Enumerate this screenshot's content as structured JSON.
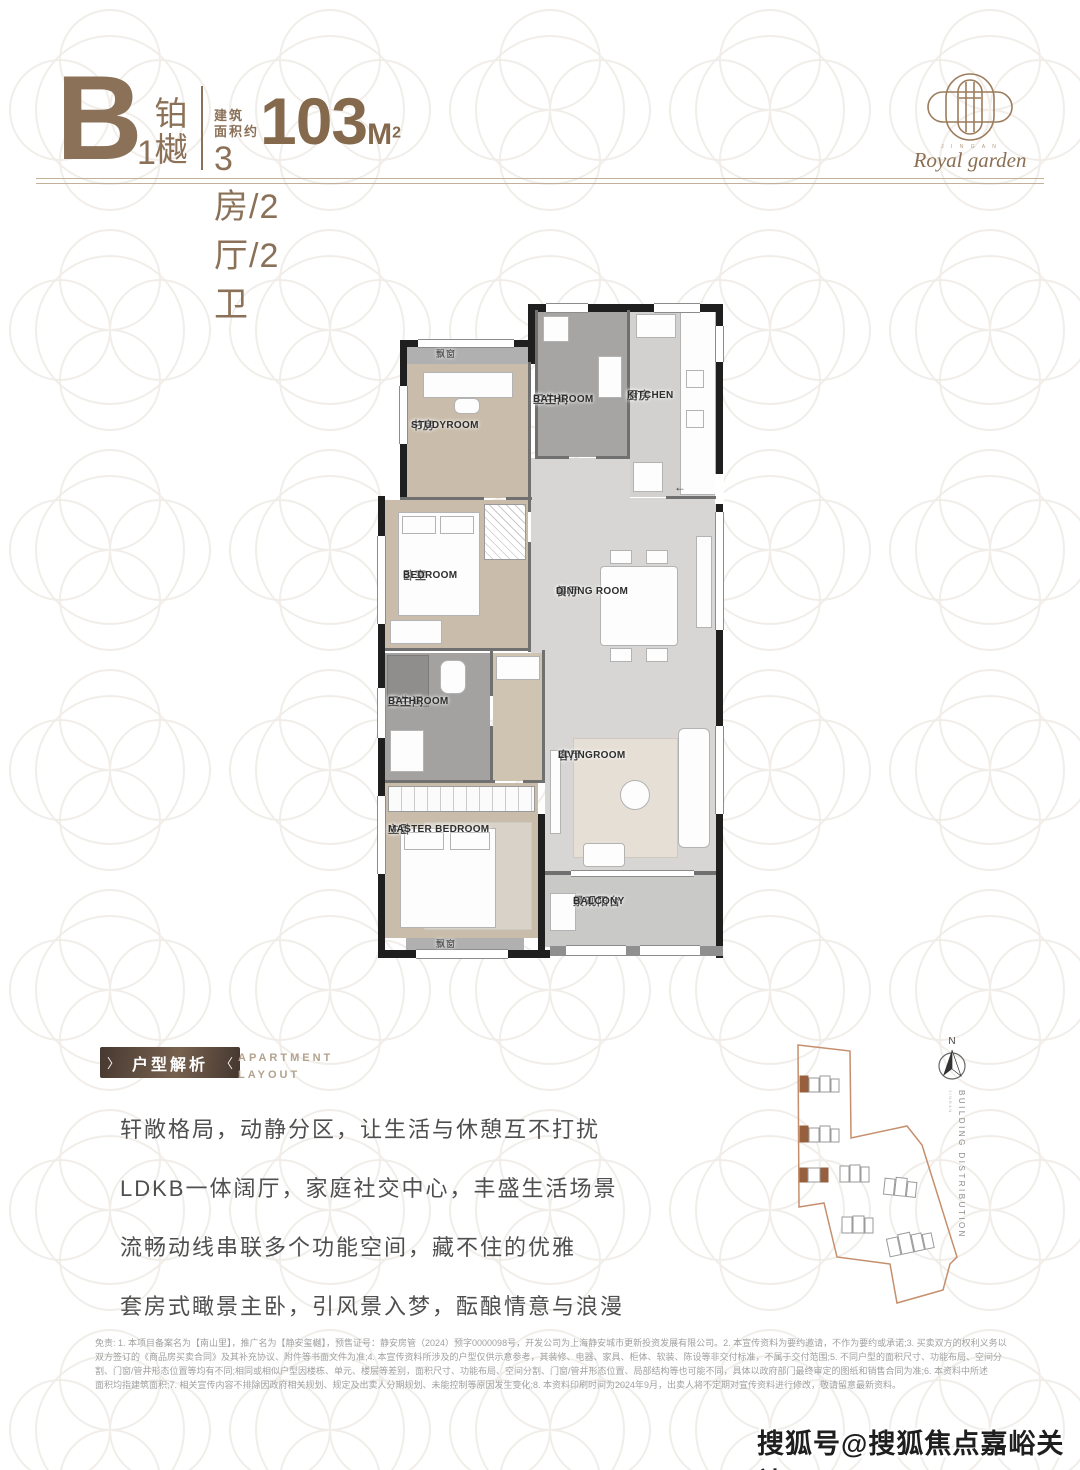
{
  "colors": {
    "accent": "#8a7158",
    "badge_dark": "#473931",
    "map_outline": "#c58f6d",
    "map_highlight": "#96603f",
    "wall_black": "#1f1f1f",
    "floor_wood": "#c9bcaa",
    "floor_marble": "#d7d6d4"
  },
  "header": {
    "type_letter": "B",
    "type_number": "1",
    "type_name_chars": [
      "铂",
      "樾"
    ],
    "area_label_line1": "建筑",
    "area_label_line2": "面积约",
    "area_value": "103",
    "area_unit": "M",
    "area_unit_sup": "2",
    "layout_spec": "3房/2厅/2卫"
  },
  "logo": {
    "brand_small": "J I N G A N",
    "brand_script": "Royal garden"
  },
  "plan": {
    "bay_window_label": "飘窗",
    "entry_arrow": "←",
    "rooms": [
      {
        "cn": "书房",
        "en": "STUDYROOM"
      },
      {
        "cn": "卫生间",
        "en": "BATHROOM"
      },
      {
        "cn": "厨房",
        "en": "KITCHEN"
      },
      {
        "cn": "卧室",
        "en": "BEDROOM"
      },
      {
        "cn": "餐厅",
        "en": "DINING ROOM"
      },
      {
        "cn": "卫生间",
        "en": "BATHROOM"
      },
      {
        "cn": "主卧",
        "en": "MASTER BEDROOM"
      },
      {
        "cn": "客厅",
        "en": "LIVINGROOM"
      },
      {
        "cn": "景观阳台",
        "en": "BALCONY"
      }
    ]
  },
  "section": {
    "badge": "户型解析",
    "badge_chevron_left": "〉",
    "badge_chevron_right": "〈",
    "subtitle_line1": "APARTMENT",
    "subtitle_line2": "LAYOUT",
    "paragraph": [
      "轩敞格局，动静分区，让生活与休憩互不打扰",
      "LDKB一体阔厅，家庭社交中心，丰盛生活场景",
      "流畅动线串联多个功能空间，藏不住的优雅",
      "套房式瞰景主卧，引风景入梦，酝酿情意与浪漫"
    ]
  },
  "sitemap": {
    "north": "N",
    "label": "BUILDING DISTRIBUTION",
    "sublabel": "JINGAN"
  },
  "disclaimer": {
    "lines": [
      "免责: 1. 本项目备案名为【南山里】，推广名为【静安玺樾】，预售证号：静安房管（2024）预字0000098号，开发公司为上海静安城市更新投资发展有限公司。2. 本宣传资料为要约邀请，不作为要约或承诺;3. 买卖双方的权利义务以",
      "双方签订的《商品房买卖合同》及其补充协议、附件等书面文件为准;4. 本宣传资料所涉及的户型仅供示意参考，其装修、电器、家具、柜体、软装、陈设等非交付标准，不属于交付范围;5. 不同户型的面积尺寸、功能布局、空间分",
      "割、门窗/管井形态位置等均有不同;相同或相似户型因楼栋、单元、楼层等差别，面积尺寸、功能布局、空间分割、门窗/管井形态位置、局部结构等也可能不同，具体以政府部门最终审定的图纸和销售合同为准;6. 本资料中所述",
      "面积均指建筑面积;7. 相关宣传内容不排除因政府相关规划、规定及出卖人分期规划、未能控制等原因发生变化;8. 本资料印刷时间为2024年9月，出卖人将不定期对宣传资料进行修改，敬请留意最新资料。"
    ]
  },
  "watermark": "搜狐号@搜狐焦点嘉峪关站"
}
